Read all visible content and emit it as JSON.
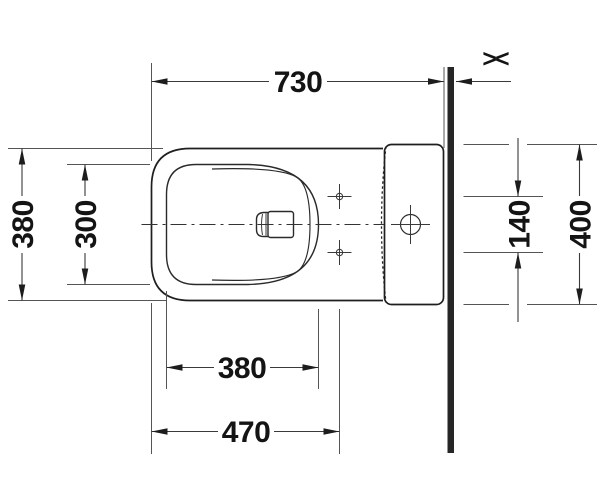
{
  "drawing": {
    "dims": {
      "overall_depth_to_wall": "730",
      "outer_body_width": "380",
      "bowl_inner_width": "300",
      "bowl_inner_depth": "380",
      "fixing_holes_from_front": "470",
      "fixing_holes_spacing": "140",
      "rear_body_width": "400"
    },
    "symbols": {
      "variable_wall_gap": "><"
    },
    "colors": {
      "outline": "#1f1f1f",
      "dimension_line": "#3a3a3a",
      "extension_line": "#555555",
      "text": "#141414",
      "wall": "#262626",
      "background": "#ffffff"
    }
  }
}
